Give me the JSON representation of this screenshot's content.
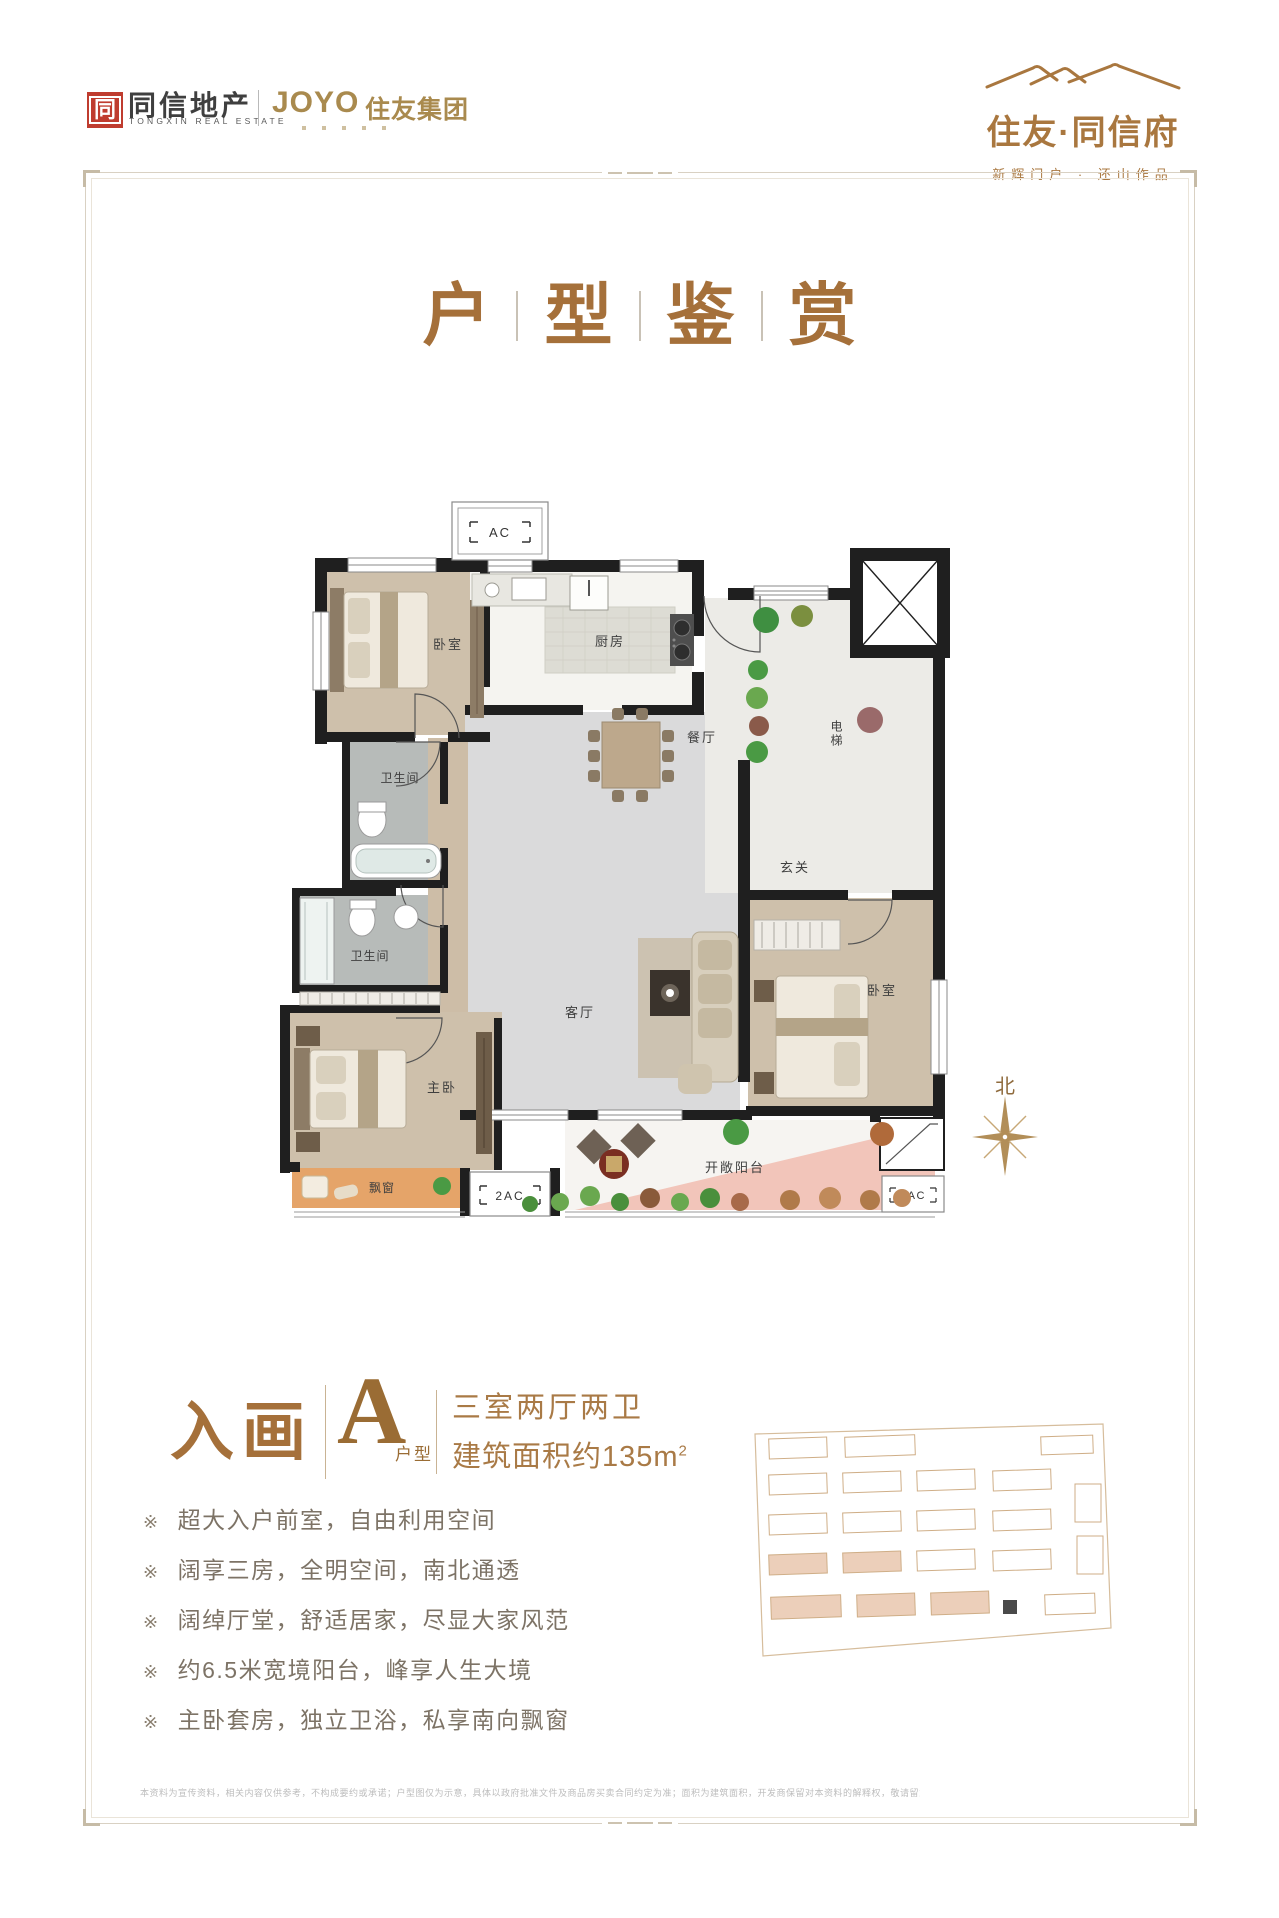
{
  "header": {
    "logo_left": {
      "mark": "同",
      "name_cn": "同信地产",
      "name_en": "TONGXIN REAL ESTATE",
      "partner_brand": "JOYO",
      "partner_name": "住友集团"
    },
    "logo_right": {
      "name": "住友·同信府",
      "tagline": "新辉门户 · 还山作品"
    }
  },
  "title": {
    "c1": "户",
    "c2": "型",
    "c3": "鉴",
    "c4": "赏"
  },
  "floor_plan": {
    "rooms": {
      "bedroom_tl": "卧室",
      "kitchen": "厨房",
      "dining": "餐厅",
      "elevator": "电梯",
      "bath1": "卫生间",
      "bath2": "卫生间",
      "foyer": "玄关",
      "living": "客厅",
      "master": "主卧",
      "bedroom_r": "卧室",
      "bay_window": "飘窗",
      "balcony": "开敞阳台"
    },
    "ac_top": "AC",
    "ac_left": "2AC",
    "ac_right": "2AC"
  },
  "info": {
    "series_name": "入画",
    "unit_letter": "A",
    "unit_label": "户型",
    "spec_line1": "三室两厅两卫",
    "area_line": "建筑面积约135m",
    "area_sup": "2"
  },
  "features": {
    "marker": "※",
    "items": [
      "超大入户前室，自由利用空间",
      "阔享三房，全明空间，南北通透",
      "阔绰厅堂，舒适居家，尽显大家风范",
      "约6.5米宽境阳台，峰享人生大境",
      "主卧套房，独立卫浴，私享南向飘窗"
    ]
  },
  "compass": {
    "north": "北"
  },
  "disclaimer": "本资料为宣传资料，相关内容仅供参考，不构成要约或承诺；户型图仅为示意，具体以政府批准文件及商品房买卖合同约定为准；面积为建筑面积，开发商保留对本资料的解释权，敬请留意最新信息。"
}
